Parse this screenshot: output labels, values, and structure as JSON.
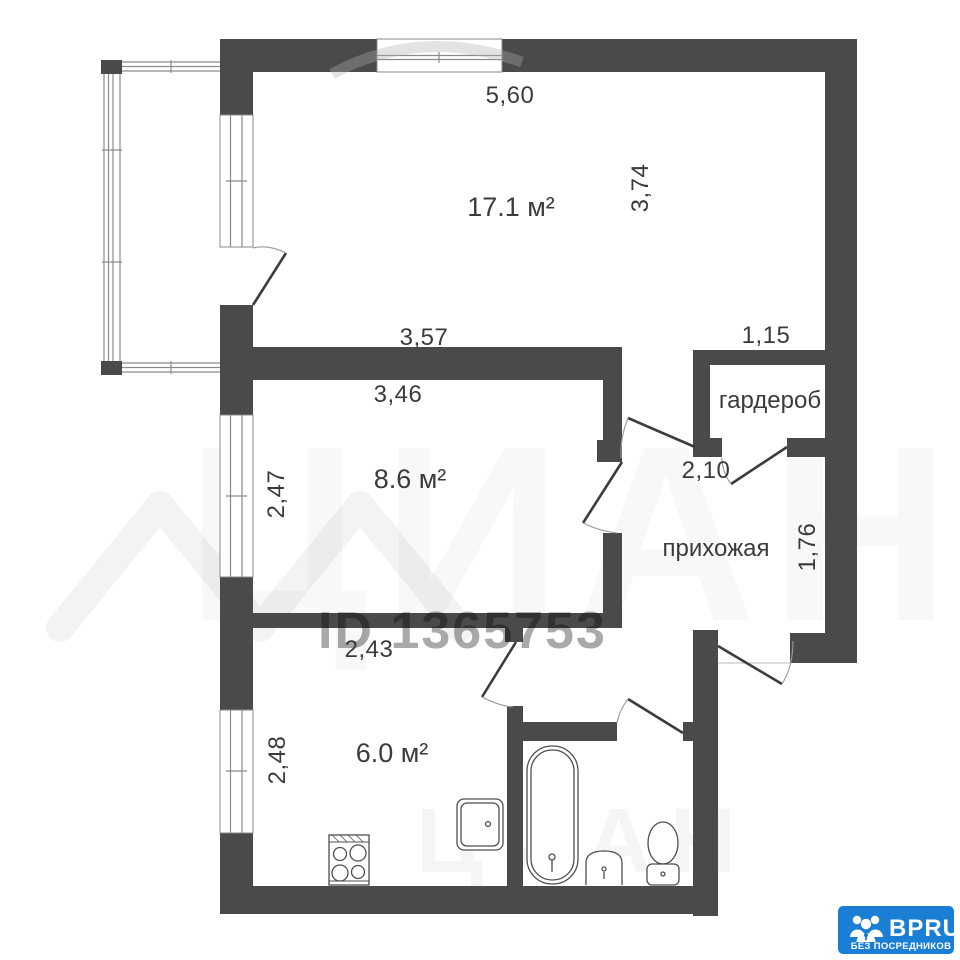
{
  "rooms": {
    "living": {
      "area": "17.1 м²"
    },
    "bedroom": {
      "area": "8.6 м²"
    },
    "kitchen": {
      "area": "6.0 м²"
    },
    "wardrobe": {
      "label": "гардероб"
    },
    "hallway": {
      "label": "прихожая"
    }
  },
  "dimensions": {
    "living_width": "5,60",
    "living_depth": "3,74",
    "living_inner_width": "3,57",
    "wardrobe_width": "1,15",
    "bedroom_width": "3,46",
    "bedroom_depth": "2,47",
    "hallway_width": "2,10",
    "hallway_depth": "1,76",
    "kitchen_width": "2,43",
    "kitchen_depth": "2,48"
  },
  "watermarks": {
    "listing_id": "ID 1365753",
    "brand_big": "ЦИАН",
    "brand_small": "ЦИАН"
  },
  "logo": {
    "name": "BPRU",
    "tagline": "БЕЗ ПОСРЕДНИКОВ",
    "bg_color": "#1a7fd4",
    "icon": "people-group-icon"
  },
  "colors": {
    "wall": "#4a4a4a",
    "background": "#ffffff"
  }
}
